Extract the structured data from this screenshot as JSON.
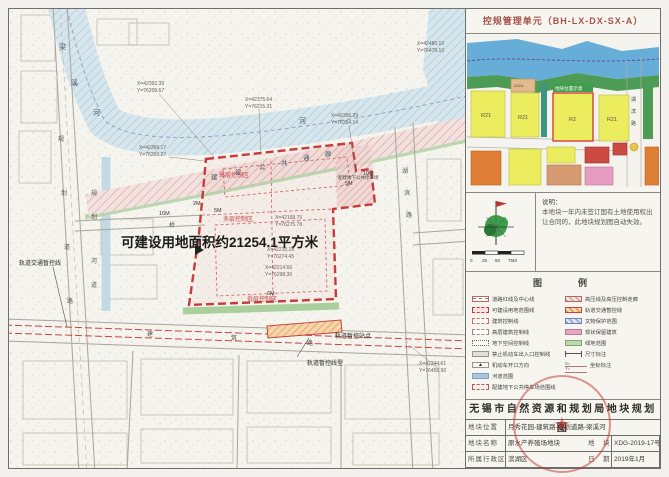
{
  "header": {
    "unit_title": "控规管理单元（BH-LX-DX-SX-A）"
  },
  "keymap": {
    "blocks": [
      "R21",
      "A32a",
      "R21",
      "R2",
      "R21"
    ],
    "tag": "地块位置示意",
    "road": [
      "湖",
      "滨",
      "路"
    ]
  },
  "notes": {
    "label": "说明：",
    "body": "本地块一年内未签订国有土地使用权出让合同的，此地块规划图自动失效。"
  },
  "scalebar": {
    "t0": "0",
    "t1": "25",
    "t2": "50",
    "t3": "75M"
  },
  "legend": {
    "title": "图　　例",
    "items_left": [
      "道路红线及中心线",
      "可建设用地范围线",
      "建筑控制线",
      "高层建筑控制线",
      "地下空间控制线",
      "禁止机动车出入口控制线",
      "机动车开口方向",
      "河道范围",
      "配建地下公共停车场范围线"
    ],
    "items_right": [
      "高压线及高压控制走廊",
      "轨道交通暂控线",
      "文物保护范围",
      "现状保留建筑",
      "绿地范围",
      "尺寸标注",
      "坐标标注"
    ],
    "open_glyph": "▲",
    "coord_sample_x": "X=",
    "coord_sample_y": "Y="
  },
  "titleblock": {
    "title": "无锡市自然资源和规划局地块规划图",
    "loc_label": "地块位置",
    "loc_value": "月秀花园-建筑路-规划道路-梁溪河",
    "name_label": "地块名称",
    "name_value": "原水产养殖场地块",
    "no_label": "地　块",
    "no_value": "XDG-2019-17号",
    "dist_label": "所属行政区",
    "dist_value": "滨湖区",
    "date_label": "日　期",
    "date_value": "2019年1月",
    "seal_star": "★"
  },
  "map": {
    "area_text": "可建设用地面积约21254.1平方米",
    "zones": [
      "高层控制区",
      "多层控制区",
      "低层控制区"
    ],
    "parking_label": "配建地下公共停车场",
    "corridor": [
      "建",
      "设",
      "公",
      "共",
      "通",
      "廊"
    ],
    "river": [
      "梁",
      "溪",
      "河",
      "河"
    ],
    "road_left": [
      "规",
      "划",
      "道",
      "路"
    ],
    "canal": [
      "规",
      "划",
      "河",
      "道"
    ],
    "bridge": "桥",
    "road_bottom": [
      "建",
      "筑",
      "路"
    ],
    "road_right": [
      "湖",
      "滨",
      "路"
    ],
    "rail_station": "轨道暂控站点",
    "rail_alignment": "轨道暂控线型",
    "rail_control": "轨道交通暂控线",
    "dims": [
      "16M",
      "2M",
      "5M",
      "5M",
      "10M",
      "6M"
    ],
    "coords": [
      {
        "x": "X=42392.39",
        "y": "Y=76209.67"
      },
      {
        "x": "X=42375.64",
        "y": "Y=76215.31"
      },
      {
        "x": "X=42369.17",
        "y": "Y=76203.27"
      },
      {
        "x": "X=42356.29",
        "y": "Y=76354.14"
      },
      {
        "x": "X=42480.10",
        "y": "Y=76479.10"
      },
      {
        "x": "X=42168.75",
        "y": "Y=76275.78"
      },
      {
        "x": "X=42213.19",
        "y": "Y=76274.45"
      },
      {
        "x": "X=42214.66",
        "y": "Y=76298.30"
      },
      {
        "x": "X=42344.61",
        "y": "Y=76458.90"
      }
    ]
  }
}
